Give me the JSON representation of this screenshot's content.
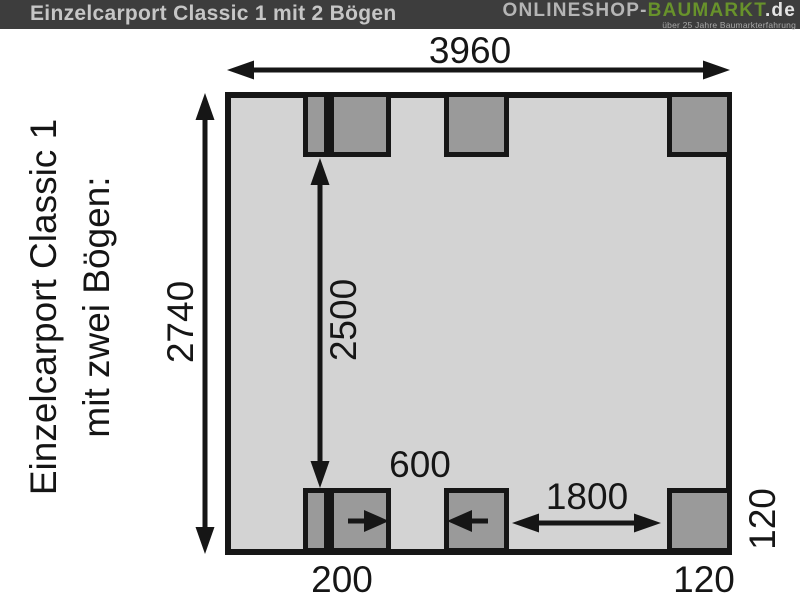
{
  "header": {
    "title": "Einzelcarport Classic 1 mit 2 Bögen",
    "logo_part1": "ONLINESHOP-",
    "logo_part2": "BAUMARKT",
    "logo_part3": ".de",
    "tagline": "über 25 Jahre Baumarkterfahrung"
  },
  "side_label": {
    "line1": "Einzelcarport Classic 1",
    "line2": "mit zwei Bögen:"
  },
  "diagram": {
    "dimensions": {
      "total_width": "3960",
      "total_depth": "2740",
      "inner_span": "2500",
      "post_gap_small": "600",
      "post_gap_large": "1800",
      "post_group_width": "200",
      "post_width": "120",
      "post_depth": "120"
    },
    "colors": {
      "plan_fill": "#d3d3d3",
      "post_fill": "#9a9a9a",
      "line": "#161616",
      "header_bg": "#3d3d3d",
      "logo_green": "#68922b"
    }
  }
}
